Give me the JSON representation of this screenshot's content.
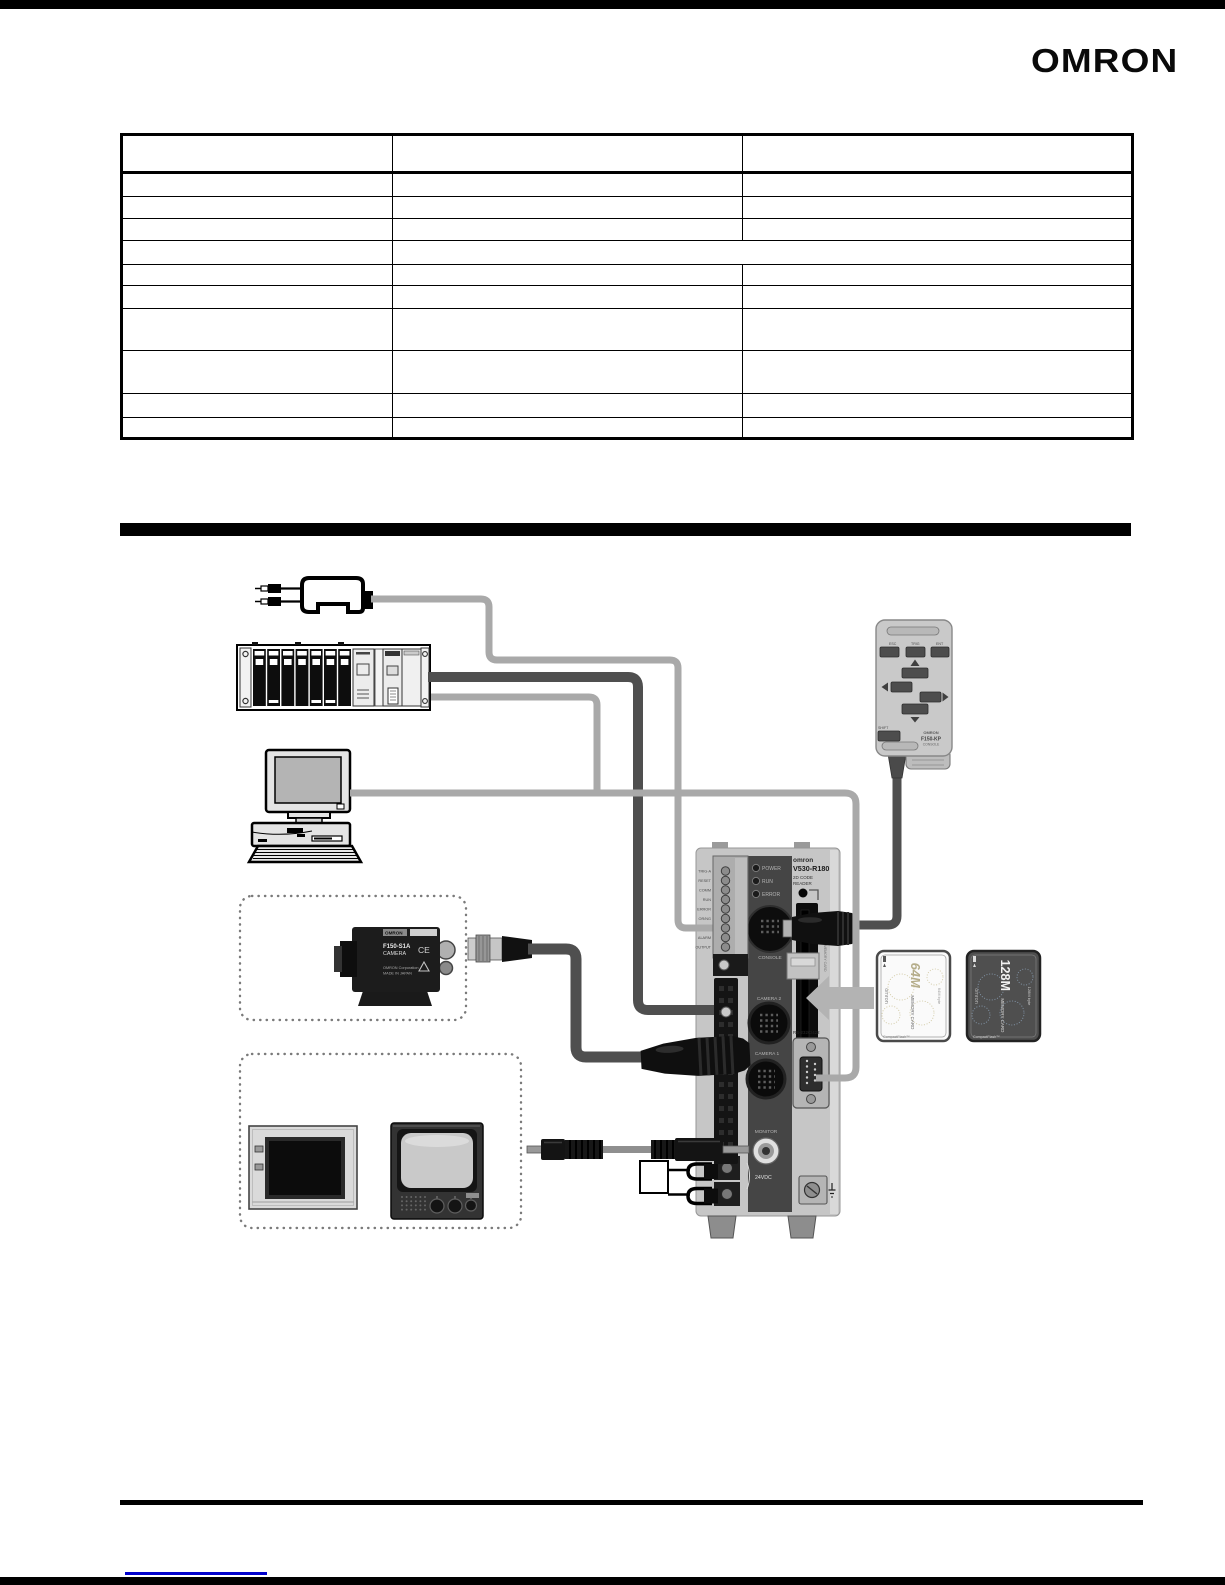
{
  "header": {
    "logo": "OMRON"
  },
  "table": {
    "columns": 3,
    "rows": 11
  },
  "diagram": {
    "console": {
      "btn_esc": "ESC",
      "btn_trig": "TRIG",
      "btn_ent": "ENT",
      "btn_shift": "SHIFT",
      "brand": "OMRON",
      "model": "F150-KP",
      "caption": "CONSOLE"
    },
    "controller": {
      "brand": "omron",
      "model": "V530-R180",
      "type_line1": "2D CODE",
      "type_line2": "READER",
      "led_power": "POWER",
      "led_run": "RUN",
      "led_error": "ERROR",
      "io_labels": [
        "TRIG-A",
        "RESET",
        "COMM",
        "RUN",
        "ERROR",
        "OR/NG",
        "GATE",
        "ALARM",
        "OUTPUT"
      ],
      "port_console": "CONSOLE",
      "port_camera2": "CAMERA 2",
      "port_camera1": "CAMERA 1",
      "port_monitor": "MONITOR",
      "port_serial": "RS-232C/422",
      "power_label": "24VDC",
      "slot_label": "MEMORY CARD"
    },
    "camera": {
      "brand": "OMRON",
      "model": "F150-S1A",
      "type": "CAMERA",
      "ce": "CE",
      "maker": "OMRON Corporation",
      "origin": "MADE IN JAPAN"
    },
    "cards": [
      {
        "size": "64M",
        "type": "MEMORY CARD",
        "brand": "omron",
        "capacity": "64M byte",
        "tech": "CompactFlash™"
      },
      {
        "size": "128M",
        "type": "MEMORY CARD",
        "brand": "omron",
        "capacity": "128M byte",
        "tech": "CompactFlash™"
      }
    ]
  }
}
